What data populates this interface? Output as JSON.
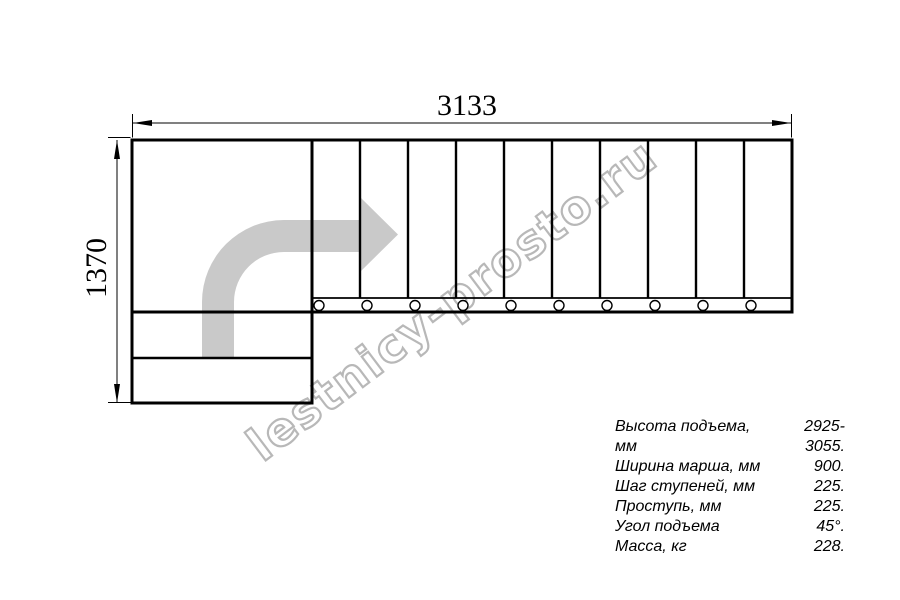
{
  "dimensions": {
    "width": "3133",
    "height": "1370"
  },
  "watermark": {
    "text": "lestnicy-prosto.ru"
  },
  "specs": {
    "rows": [
      {
        "label": "Высота подъема, мм",
        "value": "2925-3055."
      },
      {
        "label": "Ширина марша, мм",
        "value": "900."
      },
      {
        "label": "Шаг ступеней, мм",
        "value": "225."
      },
      {
        "label": "Проступь, мм",
        "value": "225."
      },
      {
        "label": "Угол подъема",
        "value": "45°."
      },
      {
        "label": "Масса, кг",
        "value": "228."
      }
    ]
  },
  "colors": {
    "line": "#000000",
    "arrow_fill": "#c9c9c9",
    "watermark": "#b8b8b8"
  }
}
